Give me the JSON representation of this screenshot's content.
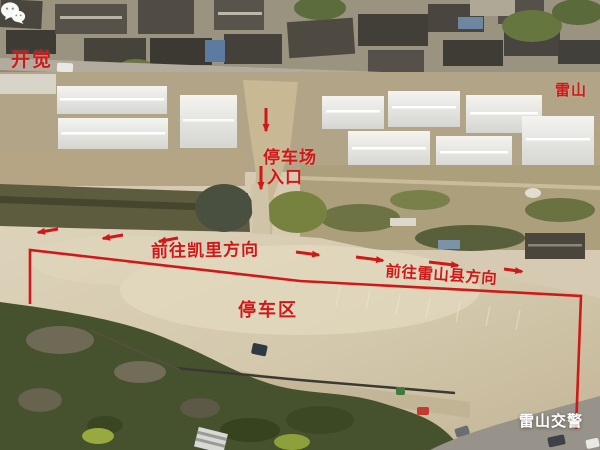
{
  "labels": {
    "village_left": "开觉",
    "village_right": "雷山",
    "entrance_line1": "停车场",
    "entrance_line2": "入口",
    "direction_kaili": "前往凯里方向",
    "direction_leishan": "前往雷山县方向",
    "parking_zone": "停车区"
  },
  "watermark": {
    "label": "雷山交警",
    "icon": "wechat-icon"
  },
  "colors": {
    "annotation_red": "#d11818",
    "watermark_white": "#ffffff"
  }
}
